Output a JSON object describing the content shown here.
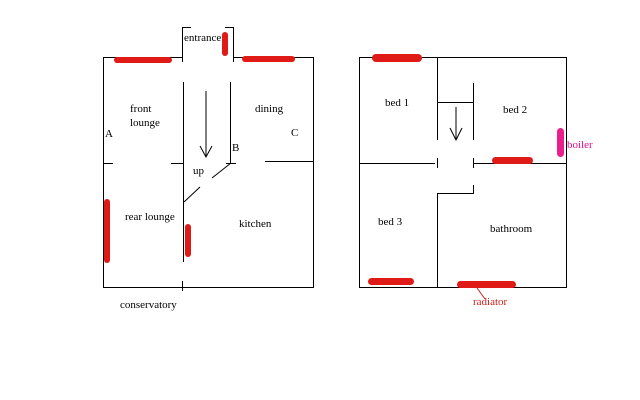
{
  "ground_floor": {
    "entrance": "entrance",
    "front_lounge": "front\nlounge",
    "rear_lounge": "rear lounge",
    "dining": "dining",
    "kitchen": "kitchen",
    "conservatory": "conservatory",
    "up": "up",
    "marker_a": "A",
    "marker_b": "B",
    "marker_c": "C"
  },
  "first_floor": {
    "bed1": "bed 1",
    "bed2": "bed 2",
    "bed3": "bed 3",
    "bathroom": "bathroom",
    "boiler": "boiler",
    "radiator": "radiator"
  },
  "colors": {
    "wall": "#000000",
    "radiator_bar": "#e01a17",
    "boiler_bar": "#ea1e8c",
    "radiator_label": "#cc2018",
    "boiler_label": "#e6108e"
  }
}
